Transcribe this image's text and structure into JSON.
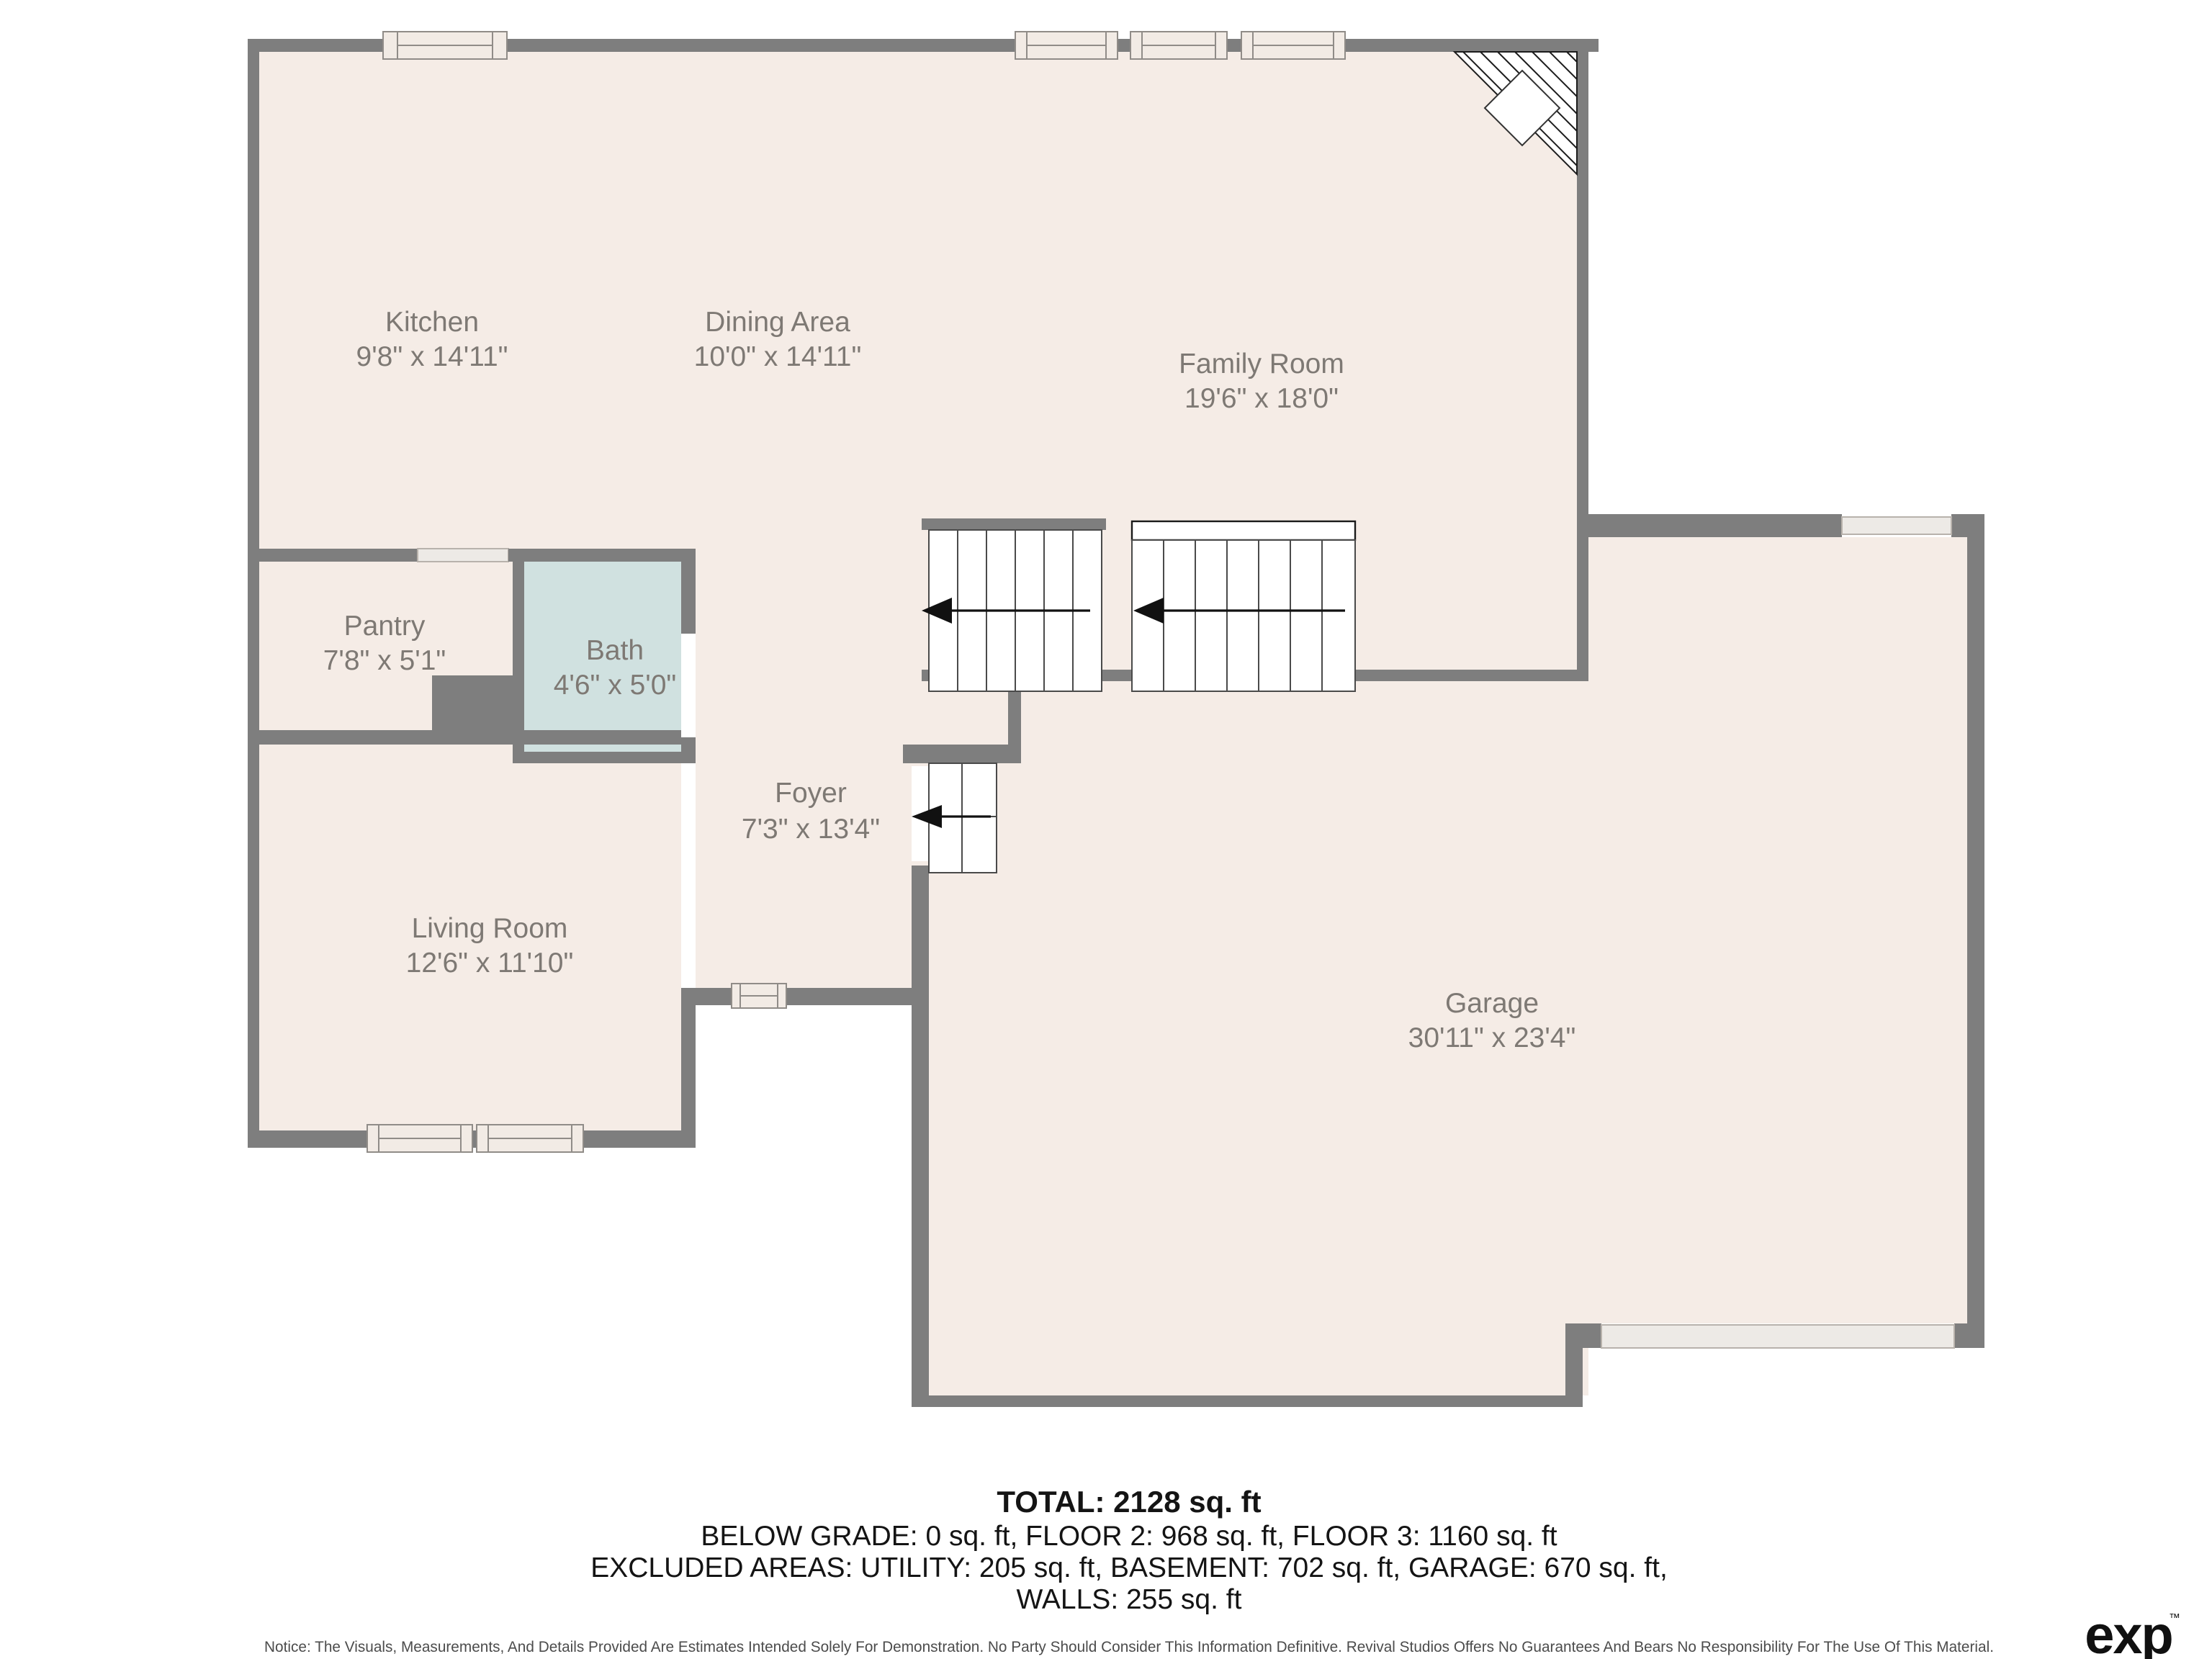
{
  "plan": {
    "rooms": {
      "kitchen": {
        "name": "Kitchen",
        "dims": "9'8\" x 14'11\""
      },
      "dining": {
        "name": "Dining Area",
        "dims": "10'0\" x 14'11\""
      },
      "family": {
        "name": "Family Room",
        "dims": "19'6\" x 18'0\""
      },
      "pantry": {
        "name": "Pantry",
        "dims": "7'8\" x 5'1\""
      },
      "bath": {
        "name": "Bath",
        "dims": "4'6\" x 5'0\""
      },
      "foyer": {
        "name": "Foyer",
        "dims": "7'3\" x 13'4\""
      },
      "living": {
        "name": "Living Room",
        "dims": "12'6\" x 11'10\""
      },
      "garage": {
        "name": "Garage",
        "dims": "30'11\" x 23'4\""
      }
    },
    "colors": {
      "wall": "#7e7e7e",
      "floor": "#f5ece6",
      "bath_floor": "#d0e1e0",
      "label_text": "#7e7974"
    }
  },
  "summary": {
    "total": "TOTAL: 2128 sq. ft",
    "line2": "BELOW GRADE: 0 sq. ft, FLOOR 2: 968 sq. ft, FLOOR 3: 1160 sq. ft",
    "line3": "EXCLUDED AREAS: UTILITY: 205 sq. ft, BASEMENT: 702 sq. ft, GARAGE: 670 sq. ft,",
    "line4": "WALLS: 255 sq. ft"
  },
  "notice": "Notice: The Visuals, Measurements, And Details Provided Are Estimates Intended Solely For Demonstration. No Party Should Consider This Information Definitive. Revival Studios Offers No Guarantees And Bears No Responsibility For The Use Of This Material.",
  "brand": {
    "name": "exp",
    "tm": "™",
    "sub": "REALTY"
  }
}
